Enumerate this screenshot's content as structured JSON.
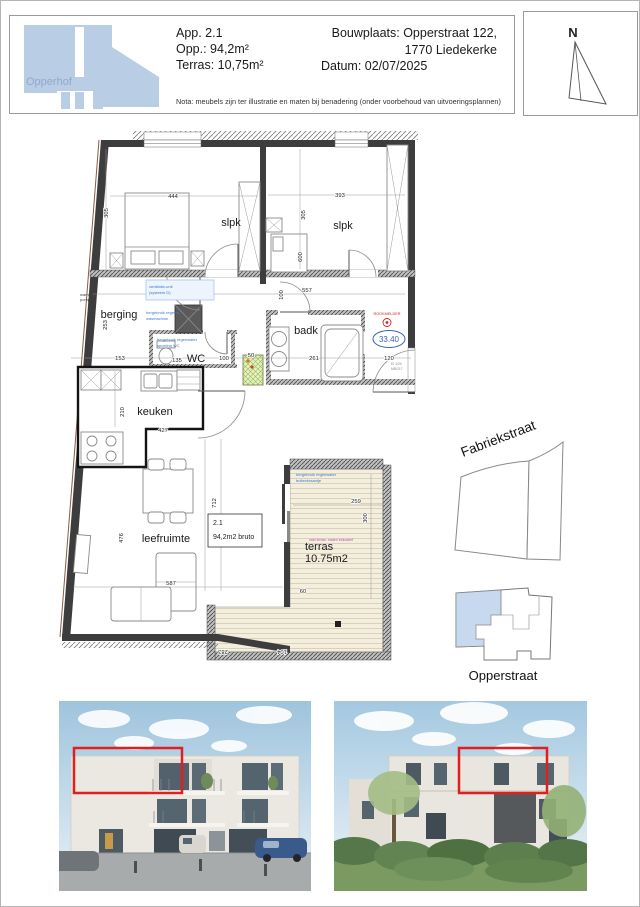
{
  "header": {
    "logo": "Opperhof",
    "app1": "App. 2.1",
    "app2": "Opp.: 94,2m²",
    "app3": "Terras: 10,75m²",
    "site1": "Bouwplaats: Opperstraat 122,",
    "site2": "1770 Liedekerke",
    "site3": "Datum: 02/07/2025",
    "nota": "Nota: meubels zijn ter illustratie en maten bij benadering (onder voorbehoud van uitvoeringsplannen)",
    "compass": "N"
  },
  "plan": {
    "rooms": {
      "slpk1": "slpk",
      "slpk2": "slpk",
      "berging": "berging",
      "badk": "badk",
      "wc": "WC",
      "keuken": "keuken",
      "leefruimte": "leefruimte",
      "terras1": "terras",
      "terras2": "10.75m2"
    },
    "unit": {
      "nr": "2.1",
      "area": "94,2m2 bruto"
    },
    "alarm": {
      "label": "ROOKMELDER",
      "value": "33.40"
    },
    "notes": {
      "warm1": "warmte-",
      "warm2": "pomp",
      "vent1": "ventilatie-unit",
      "vent2": "(systeem D)",
      "wasm1": "hergebruik regenw.",
      "wasm2": "wasmachine",
      "spoel1": "hergebruik regenwater",
      "spoel2": "spoeling WC",
      "kraan1": "hergebruik regenwater",
      "kraan2": "buitenkraantje",
      "magenta": "vast terras: maten indicatief",
      "fire1": "EI 1/2h",
      "fire2": "MB/217"
    },
    "dims": {
      "d444": "444",
      "d305a": "305",
      "d393": "393",
      "d305b": "305",
      "d600": "600",
      "d274": "274",
      "d557": "557",
      "d100a": "100",
      "d253": "253",
      "d153": "153",
      "d135": "135",
      "d100b": "100",
      "d50": "50",
      "d261": "261",
      "d120": "120",
      "d210": "210",
      "d427": "427",
      "d712": "712",
      "d476": "476",
      "d587": "587",
      "d259": "259",
      "d300": "300",
      "d60": "60",
      "d283": "283",
      "d104": "104"
    }
  },
  "maps": {
    "street": "Fabriekstraat",
    "site": "Opperstraat"
  },
  "colors": {
    "highlight_red": "#e02020",
    "logo_blue": "#b9cde5",
    "site_blue": "#c7d9ee",
    "annotation_blue": "#3a7ad0",
    "annotation_magenta": "#c050c0",
    "alarm_red": "#cc2222",
    "value_blue": "#3a66b0"
  }
}
